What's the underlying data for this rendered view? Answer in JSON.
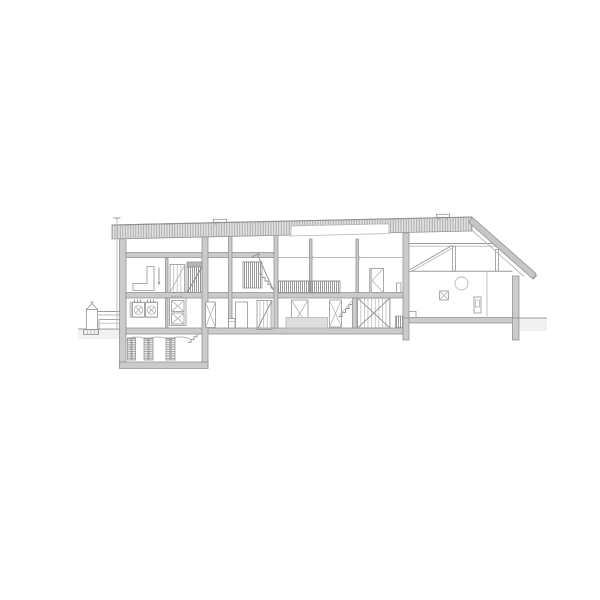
{
  "drawing": {
    "kind": "architectural-longitudinal-section",
    "description": "black-and-white line drawing of a long two-storey building section with flat hatched roof, right-hand sloped roof wing with timber truss, basement with wine-rack piers, stairs, doors and furniture; no text labels visible",
    "labels": {}
  },
  "colors": {
    "background": "#ffffff",
    "line": "#9a9a9a",
    "line_light": "#b9b9b9",
    "cut_fill": "#cbcbcb",
    "roof_fill": "#e2e2e2",
    "slope_fill": "#c6c6c6",
    "hatch": "#8a8a8a",
    "ground_fill": "#f1f1f1",
    "furniture_fill": "#dedede",
    "dark_band": "#b5b5b5",
    "white": "#ffffff"
  },
  "components": {
    "roof": [
      "flat-hatched-roof-band",
      "skylight-strip",
      "sloped-roof-right",
      "roof-vent-left",
      "roof-vent-right",
      "downspout"
    ],
    "structure": [
      "exterior-wall-left",
      "exterior-wall-right",
      "interior-walls",
      "ceiling-slab",
      "mid-floor-slab",
      "ground-slab",
      "right-floor-slab"
    ],
    "basement": [
      "basement-walls",
      "basement-floor-slab",
      "storage-piers",
      "basement-stair",
      "vault-arcs"
    ],
    "upper_floor": [
      "l-shaped-partition",
      "pull-cord",
      "panel-door",
      "shaft-door",
      "stair-balustrade",
      "stair-flight",
      "up-arrow",
      "mezzanine-guardrail",
      "casement-window",
      "radiator"
    ],
    "ground_floor": [
      "washing-machines",
      "appliance-stack",
      "braced-door-a",
      "wc",
      "door-leaf",
      "braced-door-b",
      "hall-doors",
      "hall-counter",
      "small-stair",
      "barn-door-x-braced",
      "hatched-box"
    ],
    "right_wing": [
      "tie-beam",
      "king-post",
      "diagonal-brace",
      "ceiling-beam",
      "round-window",
      "x-window",
      "wall-panel",
      "step-block"
    ],
    "site": [
      "ground-line-left",
      "ground-line-right",
      "garden-tank",
      "fence-rails",
      "platform",
      "hatched-plinth"
    ]
  }
}
